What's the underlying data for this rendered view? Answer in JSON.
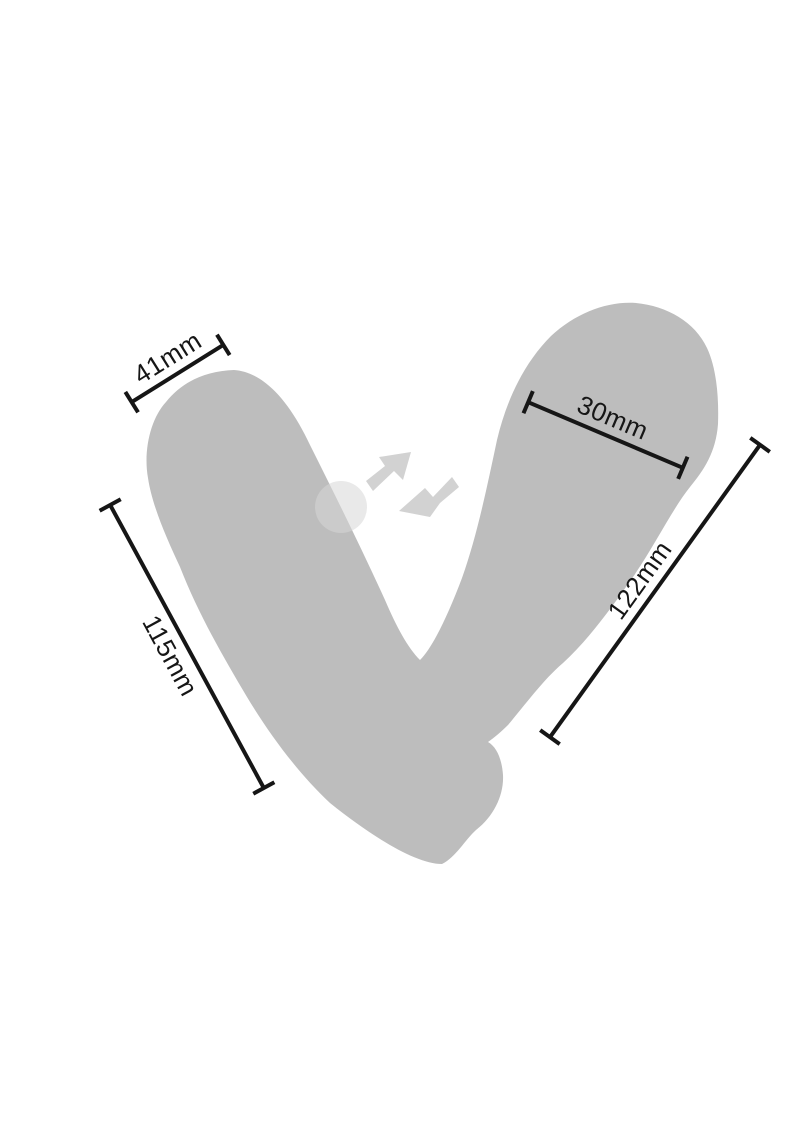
{
  "diagram": {
    "type": "product-dimension-diagram",
    "colors": {
      "background": "#ffffff",
      "silhouette": "#bdbdbd",
      "vibration_arrows": "#d2d2d2",
      "pulse_circle": "#d6d6d6",
      "dimension_lines_and_text": "#161616"
    },
    "product": {
      "name": "dual-lobe wearable device silhouette"
    },
    "dimensions": [
      {
        "id": "left-lobe-top-width",
        "label": "41mm"
      },
      {
        "id": "right-lobe-width",
        "label": "30mm"
      },
      {
        "id": "left-lobe-length",
        "label": "115mm"
      },
      {
        "id": "right-lobe-length",
        "label": "122mm"
      }
    ],
    "icons": [
      {
        "name": "vibration-arrows",
        "count": 2
      },
      {
        "name": "pulse-circle"
      }
    ]
  }
}
